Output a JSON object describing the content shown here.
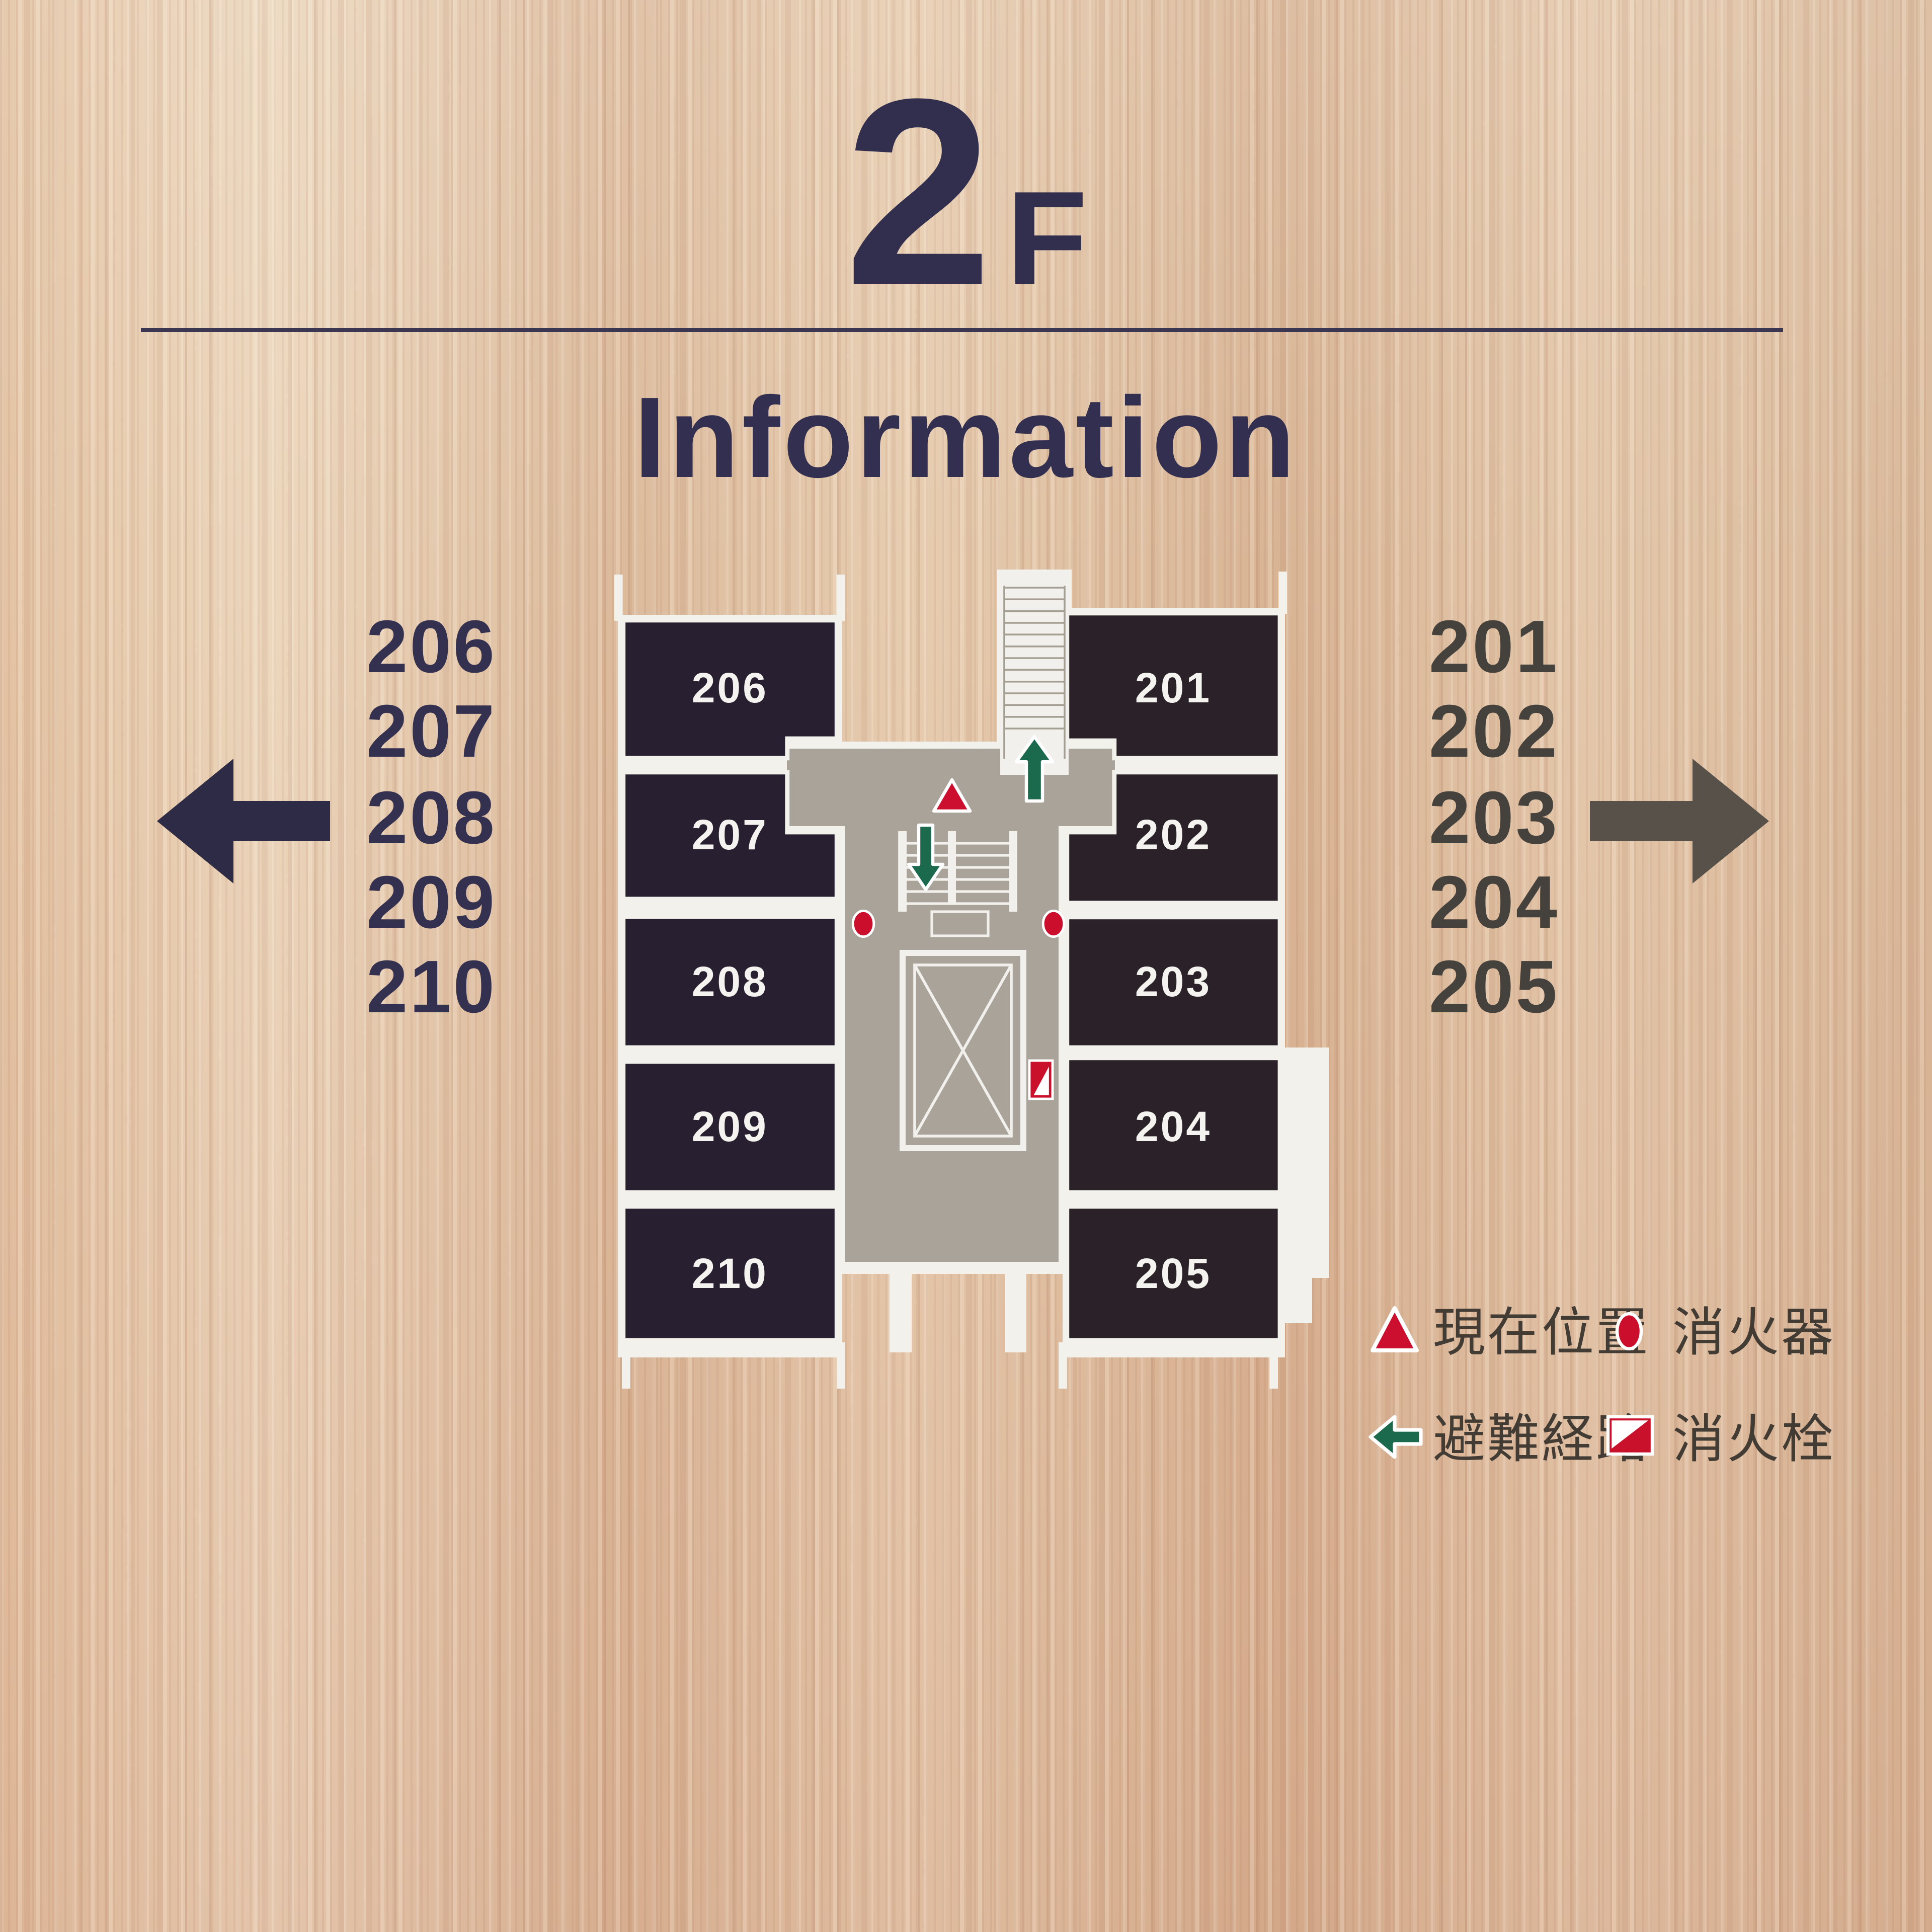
{
  "floor": {
    "number": "2",
    "letter": "F"
  },
  "title": "Information",
  "dir_left": {
    "rooms": [
      "206",
      "207",
      "208",
      "209",
      "210"
    ],
    "arrow_icon": "arrow-left-icon"
  },
  "dir_right": {
    "rooms": [
      "201",
      "202",
      "203",
      "204",
      "205"
    ],
    "arrow_icon": "arrow-right-icon"
  },
  "map": {
    "rooms_left": [
      "206",
      "207",
      "208",
      "209",
      "210"
    ],
    "rooms_right": [
      "201",
      "202",
      "203",
      "204",
      "205"
    ],
    "marker_icons": [
      "current-location-triangle",
      "evacuation-up-arrow",
      "evacuation-down-arrow",
      "fire-extinguisher-dot-left",
      "fire-extinguisher-dot-right",
      "fire-hydrant"
    ]
  },
  "legend": {
    "items": [
      {
        "icon": "current-location-triangle-icon",
        "label": "現在位置"
      },
      {
        "icon": "fire-extinguisher-dot-icon",
        "label": "消火器"
      },
      {
        "icon": "evacuation-route-arrow-icon",
        "label": "避難経路"
      },
      {
        "icon": "fire-hydrant-icon",
        "label": "消火栓"
      }
    ]
  },
  "colors": {
    "wood_base": "#debfa1",
    "ink_navy": "#322f50",
    "ink_gray": "#45413c",
    "room_fill_left": "#281f31",
    "room_fill_right": "#2a2129",
    "corridor_gray": "#a9a399",
    "wall_white": "#f3f1ec",
    "accent_red": "#cc0f2e",
    "accent_green": "#1c6a4d"
  }
}
